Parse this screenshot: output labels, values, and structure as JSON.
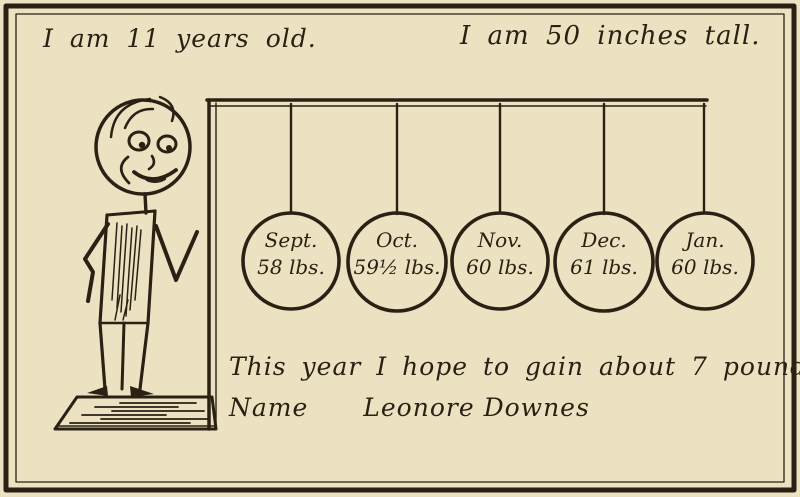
{
  "colors": {
    "paper": "#ece2c1",
    "ink": "#2a2114"
  },
  "top": {
    "age_text": "I am 11 years old.",
    "height_text": "I am 50 inches tall."
  },
  "record": {
    "entries": [
      {
        "month": "Sept.",
        "weight": "58 lbs."
      },
      {
        "month": "Oct.",
        "weight": "59½ lbs."
      },
      {
        "month": "Nov.",
        "weight": "60 lbs."
      },
      {
        "month": "Dec.",
        "weight": "61 lbs."
      },
      {
        "month": "Jan.",
        "weight": "60 lbs."
      }
    ]
  },
  "bottom": {
    "hope_text": "This year I hope to gain about 7 pounds.",
    "name_label": "Name",
    "name_value": "Leonore Downes"
  }
}
